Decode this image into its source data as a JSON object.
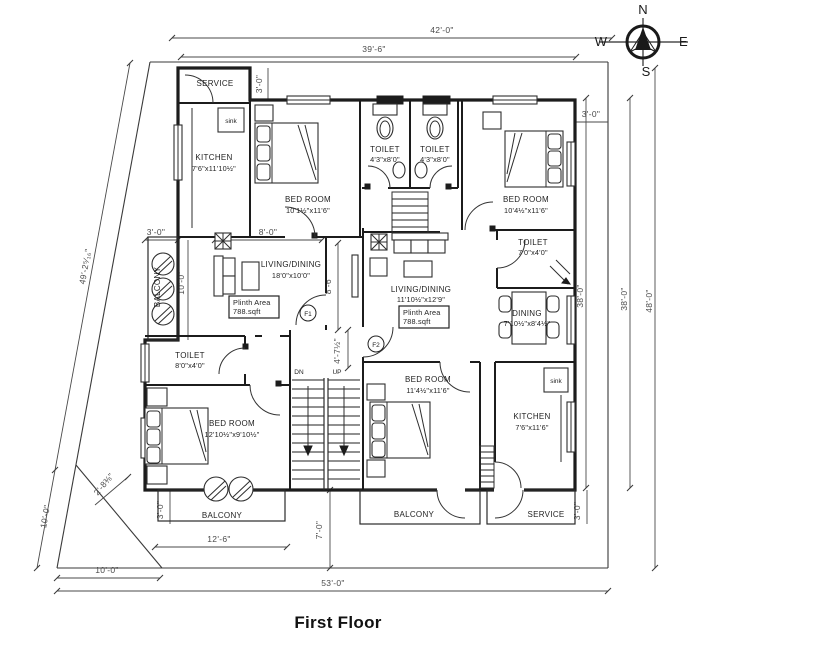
{
  "title": "First Floor",
  "compass": {
    "n": "N",
    "e": "E",
    "s": "S",
    "w": "W"
  },
  "rooms": {
    "service_top": {
      "name": "SERVICE"
    },
    "kitchen_left": {
      "name": "KITCHEN",
      "size": "7'6\"x11'10½\""
    },
    "bedroom_top_left": {
      "name": "BED ROOM",
      "size": "10'1½\"x11'6\""
    },
    "toilet_top_1": {
      "name": "TOILET",
      "size": "4'3\"x8'0\""
    },
    "toilet_top_2": {
      "name": "TOILET",
      "size": "4'3\"x8'0\""
    },
    "bedroom_top_right": {
      "name": "BED ROOM",
      "size": "10'4½\"x11'6\""
    },
    "toilet_right": {
      "name": "TOILET",
      "size": "7'0\"x4'0\""
    },
    "living_flat1": {
      "name": "LIVING/DINING",
      "size": "18'0\"x10'0\""
    },
    "living_flat2": {
      "name": "LIVING/DINING",
      "size": "11'10½\"x12'9\""
    },
    "dining_flat2": {
      "name": "DINING",
      "size": "7'10½\"x8'4½\""
    },
    "toilet_bottom_left": {
      "name": "TOILET",
      "size": "8'0\"x4'0\""
    },
    "bedroom_bottom_left": {
      "name": "BED ROOM",
      "size": "12'10½\"x9'10½\""
    },
    "bedroom_bottom_mid": {
      "name": "BED ROOM",
      "size": "11'4½\"x11'6\""
    },
    "kitchen_right": {
      "name": "KITCHEN",
      "size": "7'6\"x11'6\""
    },
    "balcony_west": {
      "name": "BALCONY"
    },
    "balcony_bottom_left": {
      "name": "BALCONY"
    },
    "balcony_bottom_mid": {
      "name": "BALCONY"
    },
    "service_bottom": {
      "name": "SERVICE"
    }
  },
  "labels": {
    "plinth_line1": "Plinth Area",
    "plinth_line2": "788.sqft",
    "flat1": "F1",
    "flat2": "F2",
    "down": "DN",
    "up": "UP",
    "sink": "sink"
  },
  "dimensions": {
    "top_outer": "42'-0\"",
    "top_inner": "39'-6\"",
    "service_depth": "3'-0\"",
    "foyer_width": "8'-0\"",
    "balcony_west_width": "3'-0\"",
    "balcony_west_length": "10'-0\"",
    "living_depth": "8'-6\"",
    "east_offset": "3'-0\"",
    "east_inner": "38'-0\"",
    "east_mid": "38'-0\"",
    "east_outer": "48'-0\"",
    "stair_width": "4'-7½\"",
    "west_boundary_upper": "49'-2⁵⁄₁₆\"",
    "west_boundary_lower": "10'-0\"",
    "corner_cut": "2'-8⅜\"",
    "bottom_west": "10'-0\"",
    "balcony_bl_depth": "3'-0\"",
    "balcony_bl_width": "12'-6\"",
    "front_offset": "7'-0\"",
    "service_bottom_depth": "3'-0\"",
    "bottom_outer": "53'-0\""
  }
}
